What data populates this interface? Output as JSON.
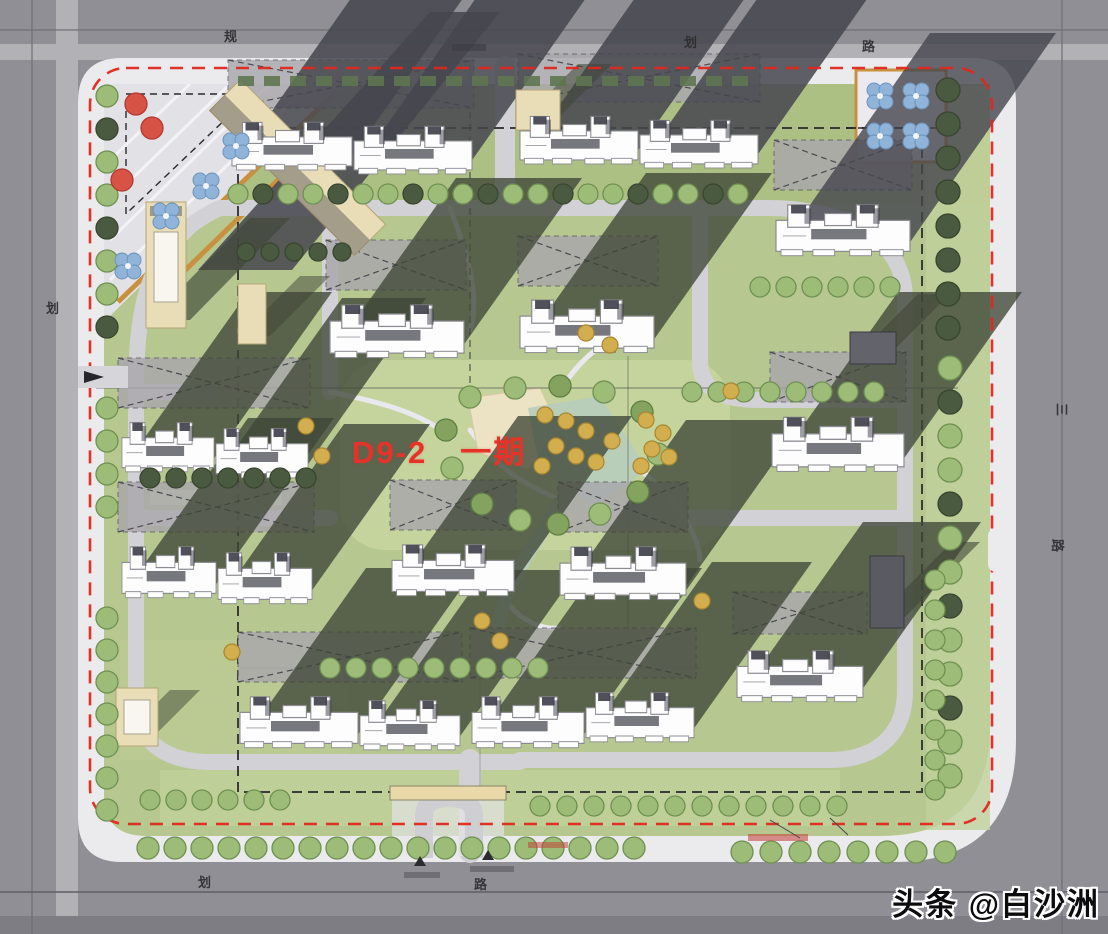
{
  "plan": {
    "phase_label": "D9-2　一期",
    "watermark": "头条 @白沙洲",
    "road_labels": [
      {
        "text": "规",
        "x": 224,
        "y": 26,
        "rot": 0
      },
      {
        "text": "划",
        "x": 684,
        "y": 32,
        "rot": 0
      },
      {
        "text": "路",
        "x": 862,
        "y": 36,
        "rot": 0
      },
      {
        "text": "划",
        "x": 46,
        "y": 298,
        "rot": 0
      },
      {
        "text": "三",
        "x": 1056,
        "y": 400,
        "rot": 90
      },
      {
        "text": "路",
        "x": 1052,
        "y": 536,
        "rot": 90
      },
      {
        "text": "划",
        "x": 198,
        "y": 872,
        "rot": 0
      },
      {
        "text": "路",
        "x": 474,
        "y": 874,
        "rot": 0
      }
    ]
  },
  "palette": {
    "boundary_red": "#e1271c",
    "phase_label_red": "#e63329",
    "road_gray": "#8f8f95",
    "sidewalk": "#ebeaed",
    "grass": "#b6c890",
    "tree_green": "#9dbc78",
    "shadow_dark": "#3f4637",
    "building_white": "#fdfdfe",
    "podium_tan": "#e8ddb6",
    "path_orange": "#c9913f",
    "water": "#b7cdbd",
    "blue_trees": "#8fb3d9",
    "red_trees": "#d85246",
    "yellow_trees": "#d3ae4e"
  }
}
